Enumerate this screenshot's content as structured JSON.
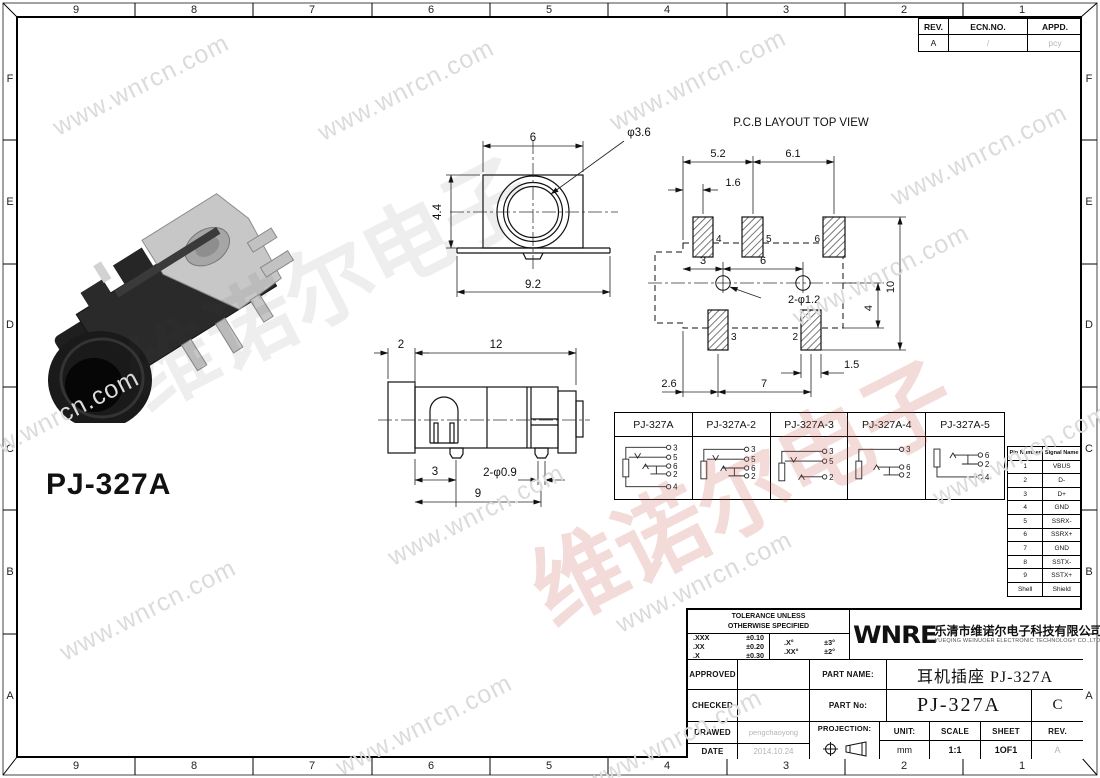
{
  "frame": {
    "cols": [
      "9",
      "8",
      "7",
      "6",
      "5",
      "4",
      "3",
      "2",
      "1"
    ],
    "rows": [
      "F",
      "E",
      "D",
      "C",
      "B",
      "A"
    ]
  },
  "revision_table": {
    "headers": [
      "REV.",
      "ECN.NO.",
      "APPD."
    ],
    "values": [
      "A",
      "/",
      "pcy"
    ]
  },
  "watermark": {
    "url": "www.wnrcn.com",
    "brand_cn": "维诺尔电子"
  },
  "product": {
    "label": "PJ-327A"
  },
  "front_view": {
    "width_top": "6",
    "hole": "φ3.6",
    "height": "4.4",
    "width_bottom": "9.2"
  },
  "side_view": {
    "cap": "2",
    "length": "12",
    "pin_offset": "3",
    "pin_holes": "2-φ0.9",
    "pin_span": "9"
  },
  "pcb_layout": {
    "title": "P.C.B LAYOUT TOP VIEW",
    "pitch_left": "5.2",
    "pitch_right": "6.1",
    "offset": "1.6",
    "hole_offset": "3",
    "hole_pitch": "6",
    "holes": "2-φ1.2",
    "pad_width": "1.5",
    "bottom_offset": "2.6",
    "bottom_pitch": "7",
    "height_center": "4",
    "height_total": "10",
    "pads": {
      "p4": "4",
      "p5": "5",
      "p6": "6",
      "p3": "3",
      "p2": "2"
    }
  },
  "variants": {
    "columns": [
      {
        "name": "PJ-327A",
        "pins": [
          "3",
          "5",
          "6",
          "2",
          "4"
        ]
      },
      {
        "name": "PJ-327A-2",
        "pins": [
          "3",
          "5",
          "6",
          "2"
        ]
      },
      {
        "name": "PJ-327A-3",
        "pins": [
          "3",
          "5",
          "2"
        ]
      },
      {
        "name": "PJ-327A-4",
        "pins": [
          "3",
          "6",
          "2"
        ]
      },
      {
        "name": "PJ-327A-5",
        "pins": [
          "6",
          "2",
          "4"
        ]
      }
    ]
  },
  "pin_table": {
    "headers": [
      "Pin Number",
      "Signal Name"
    ],
    "rows": [
      [
        "1",
        "VBUS"
      ],
      [
        "2",
        "D-"
      ],
      [
        "3",
        "D+"
      ],
      [
        "4",
        "GND"
      ],
      [
        "5",
        "SSRX-"
      ],
      [
        "6",
        "SSRX+"
      ],
      [
        "7",
        "GND"
      ],
      [
        "8",
        "SSTX-"
      ],
      [
        "9",
        "SSTX+"
      ],
      [
        "Shell",
        "Shield"
      ]
    ]
  },
  "title_block": {
    "tolerance_title_1": "TOLERANCE UNLESS",
    "tolerance_title_2": "OTHERWISE SPECIFIED",
    "tol_linear": [
      [
        ".XXX",
        "±0.10"
      ],
      [
        ".XX",
        "±0.20"
      ],
      [
        ".X",
        "±0.30"
      ]
    ],
    "tol_angular": [
      [
        ".X°",
        "±3°"
      ],
      [
        ".XX°",
        "±2°"
      ]
    ],
    "approval_rows": [
      {
        "label": "APPROVED",
        "value": ""
      },
      {
        "label": "CHECKED",
        "value": ""
      },
      {
        "label": "DRAWED",
        "value": "pengchaoyong"
      },
      {
        "label": "DATE",
        "value": "2014.10.24"
      }
    ],
    "logo": "WNRE",
    "company_cn": "乐清市维诺尔电子科技有限公司",
    "company_en": "YUEQING WEINUOER ELECTRONIC TECHNOLOGY CO.,LTD.",
    "part_name_label": "PART NAME:",
    "part_name": "耳机插座 PJ-327A",
    "part_no_label": "PART No:",
    "part_no": "PJ-327A",
    "part_no_rev": "C",
    "projection_label": "PROJECTION:",
    "unit_label": "UNIT:",
    "unit": "mm",
    "scale_label": "SCALE",
    "scale": "1:1",
    "sheet_label": "SHEET",
    "sheet": "1OF1",
    "rev_label": "REV.",
    "rev": "A"
  }
}
